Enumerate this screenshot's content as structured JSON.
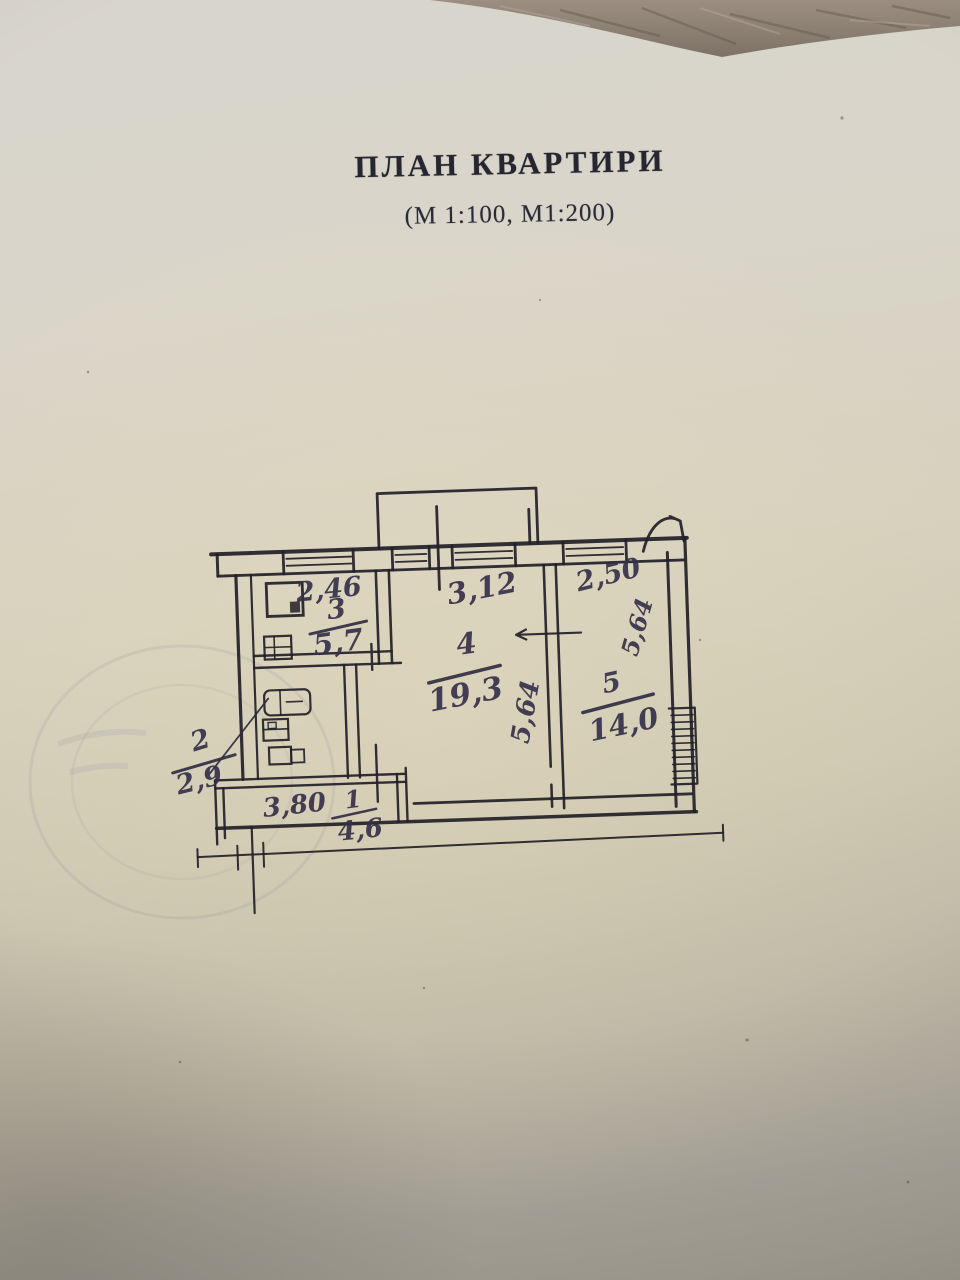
{
  "page": {
    "title": "ПЛАН КВАРТИРИ",
    "subtitle": "(М 1:100, М1:200)"
  },
  "plan": {
    "rooms": [
      {
        "id": "kitchen",
        "number": "3",
        "area": "5,7",
        "width": "2,46"
      },
      {
        "id": "living",
        "number": "4",
        "area": "19,3",
        "width": "3,12",
        "depth": "5,64"
      },
      {
        "id": "bedroom",
        "number": "5",
        "area": "14,0",
        "width": "2,50",
        "depth": "5,64"
      },
      {
        "id": "hallway",
        "number": "1",
        "area": "4,6",
        "width": "3,80"
      },
      {
        "id": "bathroom",
        "number": "2",
        "area": "2,9"
      }
    ]
  }
}
